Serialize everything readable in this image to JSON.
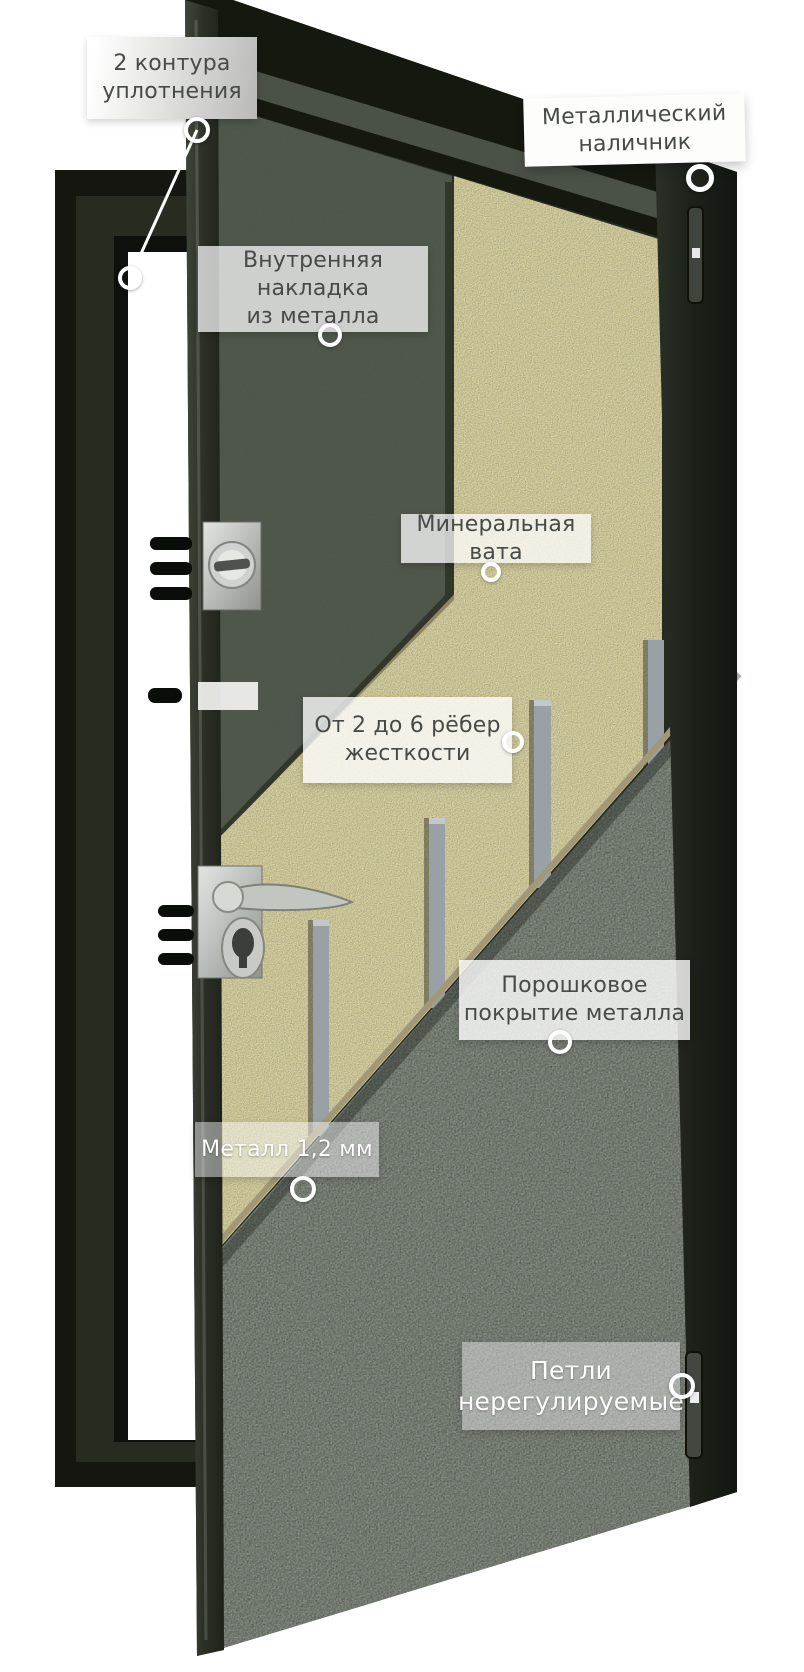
{
  "figure": {
    "kind": "steel-door-construction-cutaway-diagram",
    "language": "ru"
  },
  "labels": [
    {
      "id": "seal",
      "text": "2 контура уплотнения",
      "lines": [
        "2 контура",
        "уплотнения"
      ]
    },
    {
      "id": "casing",
      "text": "Металлический наличник",
      "lines": [
        "Металлический",
        "наличник"
      ]
    },
    {
      "id": "inner",
      "text": "Внутренняя накладка из металла",
      "lines": [
        "Внутренняя накладка",
        "из металла"
      ]
    },
    {
      "id": "wool",
      "text": "Минеральная вата",
      "lines": [
        "Минеральная вата"
      ]
    },
    {
      "id": "ribs",
      "text": "От 2 до 6 рёбер жесткости",
      "lines": [
        "От 2 до 6 рёбер",
        "жесткости"
      ]
    },
    {
      "id": "powder",
      "text": "Порошковое покрытие металла",
      "lines": [
        "Порошковое",
        "покрытие металла"
      ]
    },
    {
      "id": "metal",
      "text": "Металл 1,2 мм",
      "lines": [
        "Металл 1,2 мм"
      ]
    },
    {
      "id": "hinges",
      "text": "Петли нерегулируемые",
      "lines": [
        "Петли",
        "нерегулируемые"
      ]
    }
  ],
  "colors": {
    "background": "#ffffff",
    "frame_dark": "#14160f",
    "frame_face": "#272b20",
    "panel": "#4e554b",
    "wool": "#ddd6a2",
    "rib": "#9aa1a6",
    "sheet": "#878d87",
    "casing_band": "#20261e",
    "label_text_dark": "#474b47",
    "label_text_light": "#ffffff",
    "marker_ring": "#ffffff"
  }
}
